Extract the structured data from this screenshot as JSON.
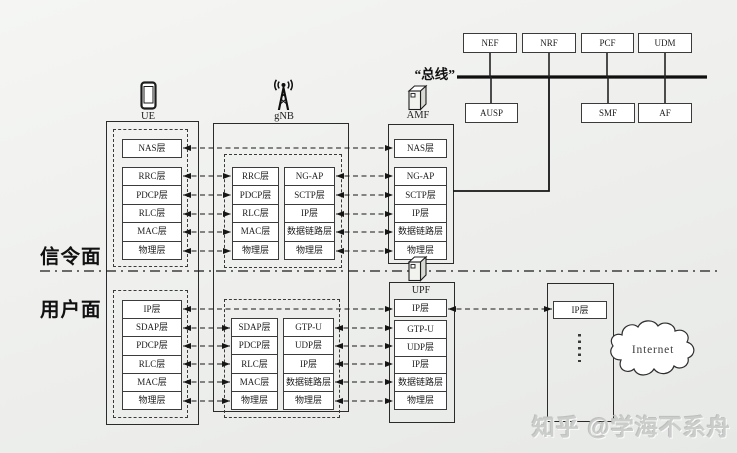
{
  "plane_labels": {
    "signaling": "信令面",
    "user": "用户面"
  },
  "bus": {
    "label": "“总线”"
  },
  "sba": {
    "top": [
      "NEF",
      "NRF",
      "PCF",
      "UDM"
    ],
    "bottom": [
      "AUSP",
      "SMF",
      "AF"
    ]
  },
  "ue": {
    "label": "UE",
    "nas": "NAS层",
    "sig_stack": [
      "RRC层",
      "PDCP层",
      "RLC层",
      "MAC层",
      "物理层"
    ],
    "usr_stack": [
      "IP层",
      "SDAP层",
      "PDCP层",
      "RLC层",
      "MAC层",
      "物理层"
    ]
  },
  "gnb": {
    "label": "gNB",
    "sig_left": [
      "RRC层",
      "PDCP层",
      "RLC层",
      "MAC层",
      "物理层"
    ],
    "sig_right": [
      "NG-AP",
      "SCTP层",
      "IP层",
      "数据链路层",
      "物理层"
    ],
    "usr_left": [
      "SDAP层",
      "PDCP层",
      "RLC层",
      "MAC层",
      "物理层"
    ],
    "usr_right": [
      "GTP-U",
      "UDP层",
      "IP层",
      "数据链路层",
      "物理层"
    ]
  },
  "amf": {
    "label": "AMF",
    "nas": "NAS层",
    "stack": [
      "NG-AP",
      "SCTP层",
      "IP层",
      "数据链路层",
      "物理层"
    ]
  },
  "upf": {
    "label": "UPF",
    "ip": "IP层",
    "stack": [
      "GTP-U",
      "UDP层",
      "IP层",
      "数据链路层",
      "物理层"
    ]
  },
  "dn": {
    "ip": "IP层",
    "cloud": "Internet"
  },
  "watermark": "知乎 @学海不系舟",
  "icons": {
    "ue": "smartphone-icon",
    "gnb": "antenna-icon",
    "amf": "server-icon",
    "upf": "server-icon",
    "dn_more": "vertical-ellipsis-icon",
    "internet": "cloud-icon"
  },
  "colors": {
    "line": "#161616",
    "box_fill": "#ffffff",
    "background": "#eff0ee",
    "watermark": "#cbcdcb"
  }
}
